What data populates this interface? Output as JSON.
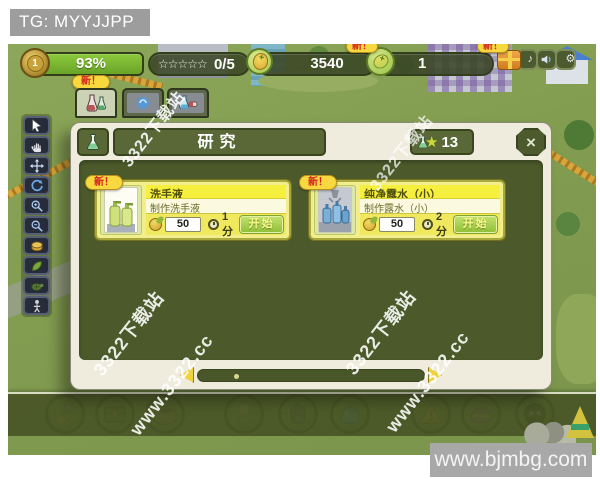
{
  "banner": {
    "text": "TG: MYYJJPP"
  },
  "hud": {
    "level": "1",
    "progress": "93%",
    "new_badge": "新！",
    "stars": "☆☆☆☆☆",
    "stars_count": "0/5",
    "coins": "3540",
    "gems": "1",
    "music_icon": "♪",
    "gear_icon": "⚙"
  },
  "dialog": {
    "title": "研究",
    "count": "13",
    "close": "×",
    "cards": [
      {
        "badge": "新！",
        "title": "洗手液",
        "subtitle": "制作洗手液",
        "cost": "50",
        "time": "1分",
        "action": "开始"
      },
      {
        "badge": "新！",
        "title": "纯净露水（小）",
        "subtitle": "制作露水（小）",
        "cost": "50",
        "time": "2分",
        "action": "开始"
      }
    ]
  },
  "bottombar": {
    "new_badge": "新！"
  },
  "watermarks": [
    {
      "text": "3322下载站"
    },
    {
      "text": "3322下载站"
    },
    {
      "text": "3322下载站"
    },
    {
      "text": "www.3322.cc"
    },
    {
      "text": "3322下载站"
    },
    {
      "text": "www.3322.cc"
    }
  ],
  "site_badge": {
    "text": "www.bjmbg.com"
  }
}
